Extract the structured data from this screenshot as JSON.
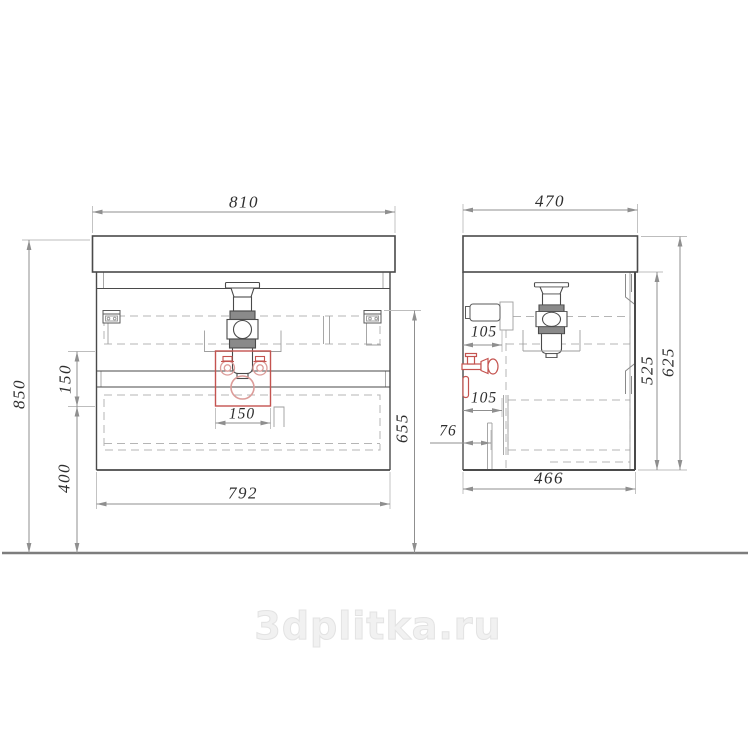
{
  "watermark_text": "3dplitka.ru",
  "views": {
    "front": {
      "dims": {
        "top_width": "810",
        "body_width": "792",
        "overall_height": "850",
        "drawer_gap_height": "150",
        "floor_clearance": "400",
        "bracket_height": "655",
        "cutout_width": "150"
      }
    },
    "side": {
      "dims": {
        "top_depth": "470",
        "body_depth": "466",
        "overall_height": "625",
        "cabinet_height": "525",
        "drain_offset_upper": "105",
        "drain_offset_lower": "105",
        "outlet_offset": "76"
      }
    }
  },
  "colors": {
    "outline": "#4a4a4a",
    "hidden_line": "#b5b5b5",
    "dimension_line": "#8f8f8f",
    "highlight_red": "#c4534f",
    "highlight_red_light": "#dc9c99",
    "watermark": "#efefef"
  }
}
